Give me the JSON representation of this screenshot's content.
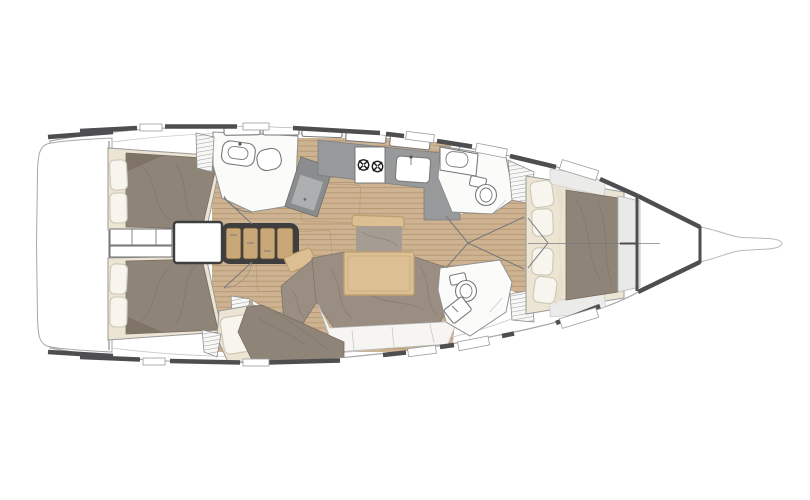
{
  "diagram": {
    "type": "yacht-interior-floorplan",
    "description": "Top-down interior layout plan of a sailing yacht, bow pointing right, stern with swim platform at left",
    "orientation": {
      "bow": "right",
      "stern": "left"
    },
    "areas": [
      {
        "id": "swim-platform",
        "label": "Swim platform / transom"
      },
      {
        "id": "aft-cabin-port",
        "label": "Aft double cabin (top)"
      },
      {
        "id": "aft-cabin-stbd",
        "label": "Aft double cabin (bottom)"
      },
      {
        "id": "aft-head",
        "label": "Aft head with shower and sink"
      },
      {
        "id": "companionway",
        "label": "Companionway entry and steps"
      },
      {
        "id": "nav-station",
        "label": "Chart table / nav station"
      },
      {
        "id": "galley",
        "label": "L-shaped galley with two-burner stove and sink"
      },
      {
        "id": "saloon",
        "label": "Saloon with table, bench and U-shaped settee"
      },
      {
        "id": "mid-berth",
        "label": "Mid single berth (bottom)"
      },
      {
        "id": "head-forward-port",
        "label": "Forward head (top) with toilet and sink"
      },
      {
        "id": "head-forward-stbd",
        "label": "Forward head (bottom) with toilet and sink"
      },
      {
        "id": "wardrobes",
        "label": "Hanging lockers (hatched)"
      },
      {
        "id": "owners-cabin",
        "label": "Forward owner's cabin with island berth and pillows"
      },
      {
        "id": "anchor-locker",
        "label": "Bow anchor locker"
      },
      {
        "id": "bowsprit",
        "label": "Bowsprit"
      }
    ],
    "palette": {
      "hullStroke": "#a8a8a8",
      "bowspritStroke": "#b8b8b8",
      "deckDark": "#4e4e50",
      "sideDeck": "#ebebe9",
      "roomFill": "#fbfbfa",
      "roomStroke": "#8f8f8f",
      "wood": "#cdb392",
      "woodLine": "#b3936c",
      "stepsWood": "#c9a877",
      "stepsFrame": "#3e3e3e",
      "counter": "#97999b",
      "counterDark": "#8a8c8e",
      "counterLight": "#adafb1",
      "counterEdge": "#7c7e80",
      "mattress": "#8f8478",
      "mattressLine": "#776c61",
      "cream": "#ede5d3",
      "pillow": "#f7f5ee",
      "pillowStroke": "#cfc9b8",
      "settee": "#9a8e82",
      "tableWood": "#dcc094",
      "tableStroke": "#bfa071",
      "fixture": "#7a7a7a",
      "seam": "#9c9c9c",
      "seamLight": "#c8c8c8",
      "line": "#777777"
    }
  }
}
